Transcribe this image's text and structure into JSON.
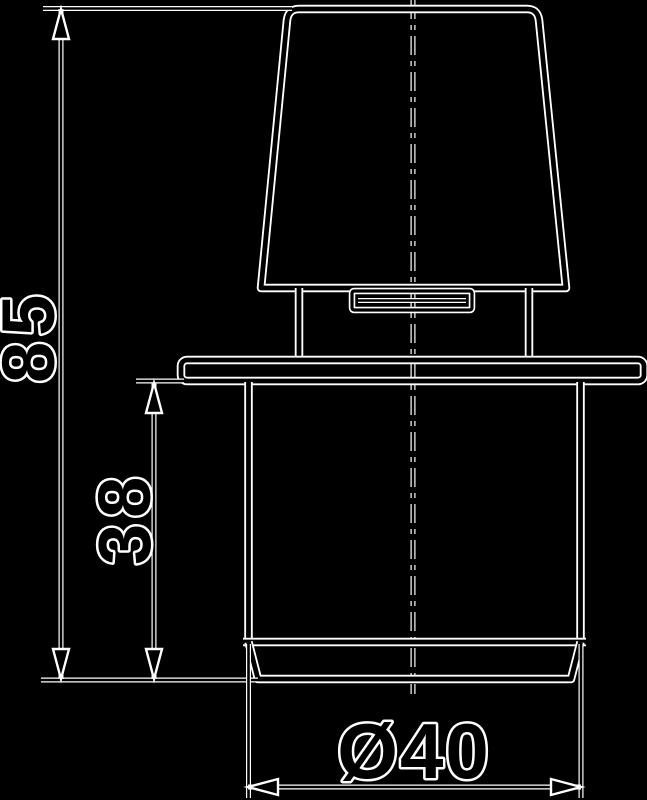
{
  "drawing": {
    "type": "technical-dimension-drawing",
    "background_color": "#000000",
    "line_halo_color": "#ffffff",
    "line_core_color": "#000000",
    "part": "conical knob with mounting plate and cylindrical insert body",
    "centerline_style": "dash-dot",
    "dimensions": {
      "total_height": {
        "label": "85",
        "orientation": "vertical"
      },
      "body_height": {
        "label": "38",
        "orientation": "vertical"
      },
      "diameter": {
        "label": "Ø40",
        "orientation": "horizontal"
      }
    }
  }
}
